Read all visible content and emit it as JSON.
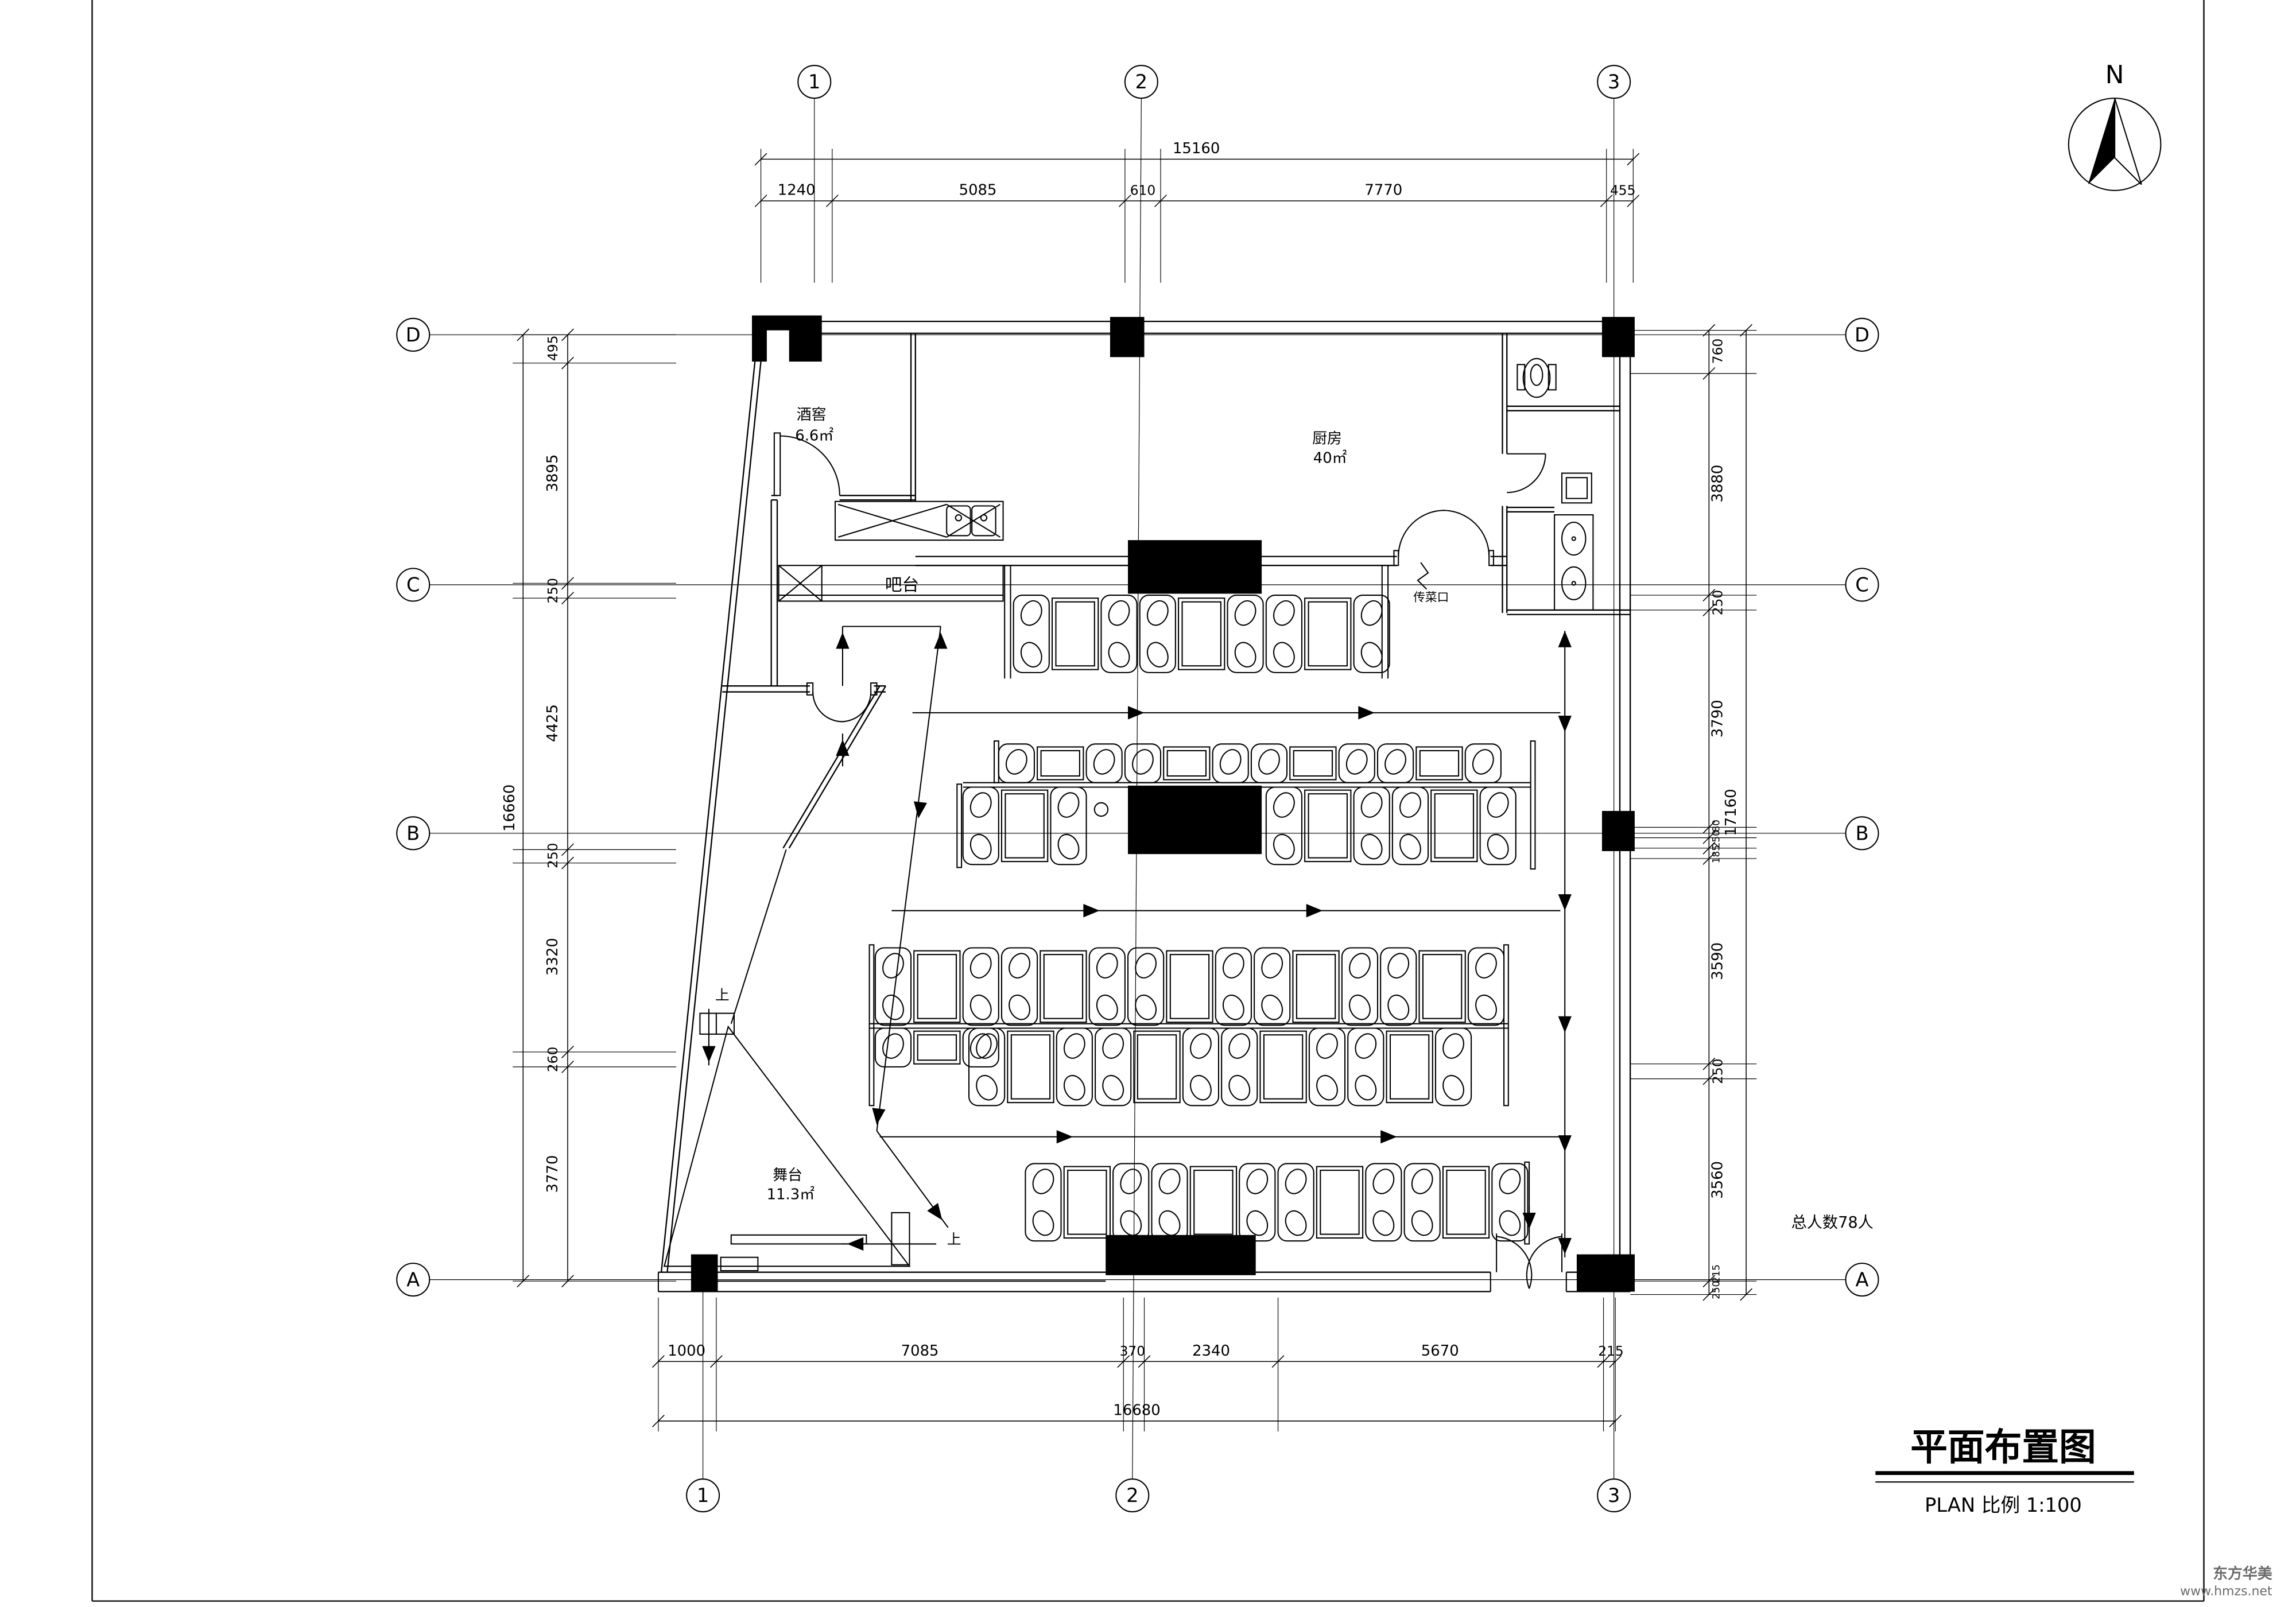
{
  "title_block": {
    "title": "平面布置图",
    "scale_line": "PLAN 比例 1:100"
  },
  "north_label": "N",
  "watermark": {
    "line1": "东方华美",
    "line2": "www.hmzs.net"
  },
  "notes": {
    "total_capacity": "总人数78人"
  },
  "grid": {
    "top": [
      "1",
      "2",
      "3"
    ],
    "bottom": [
      "1",
      "2",
      "3"
    ],
    "left": [
      "D",
      "C",
      "B",
      "A"
    ],
    "right": [
      "D",
      "C",
      "B",
      "A"
    ]
  },
  "rooms": {
    "wine_cellar": {
      "name": "酒窖",
      "area": "6.6㎡"
    },
    "kitchen": {
      "name": "厨房",
      "area": "40㎡"
    },
    "bar": {
      "name": "吧台"
    },
    "stage": {
      "name": "舞台",
      "area": "11.3㎡"
    },
    "pass": {
      "name": "传菜口"
    },
    "stair_up": "上"
  },
  "dimensions": {
    "top": {
      "total": "15160",
      "segments": [
        "1240",
        "5085",
        "610",
        "7770",
        "455"
      ]
    },
    "bottom": {
      "total": "16680",
      "segments": [
        "1000",
        "7085",
        "370",
        "2340",
        "5670",
        "215"
      ]
    },
    "left": {
      "total": "16660",
      "segments": [
        "495",
        "3895",
        "250",
        "4425",
        "250",
        "3320",
        "260",
        "3770"
      ]
    },
    "right": {
      "total": "17160",
      "segments": [
        "760",
        "3880",
        "250",
        "3790",
        "80",
        "250",
        "185",
        "3590",
        "250",
        "3560",
        "215",
        "250"
      ]
    }
  }
}
